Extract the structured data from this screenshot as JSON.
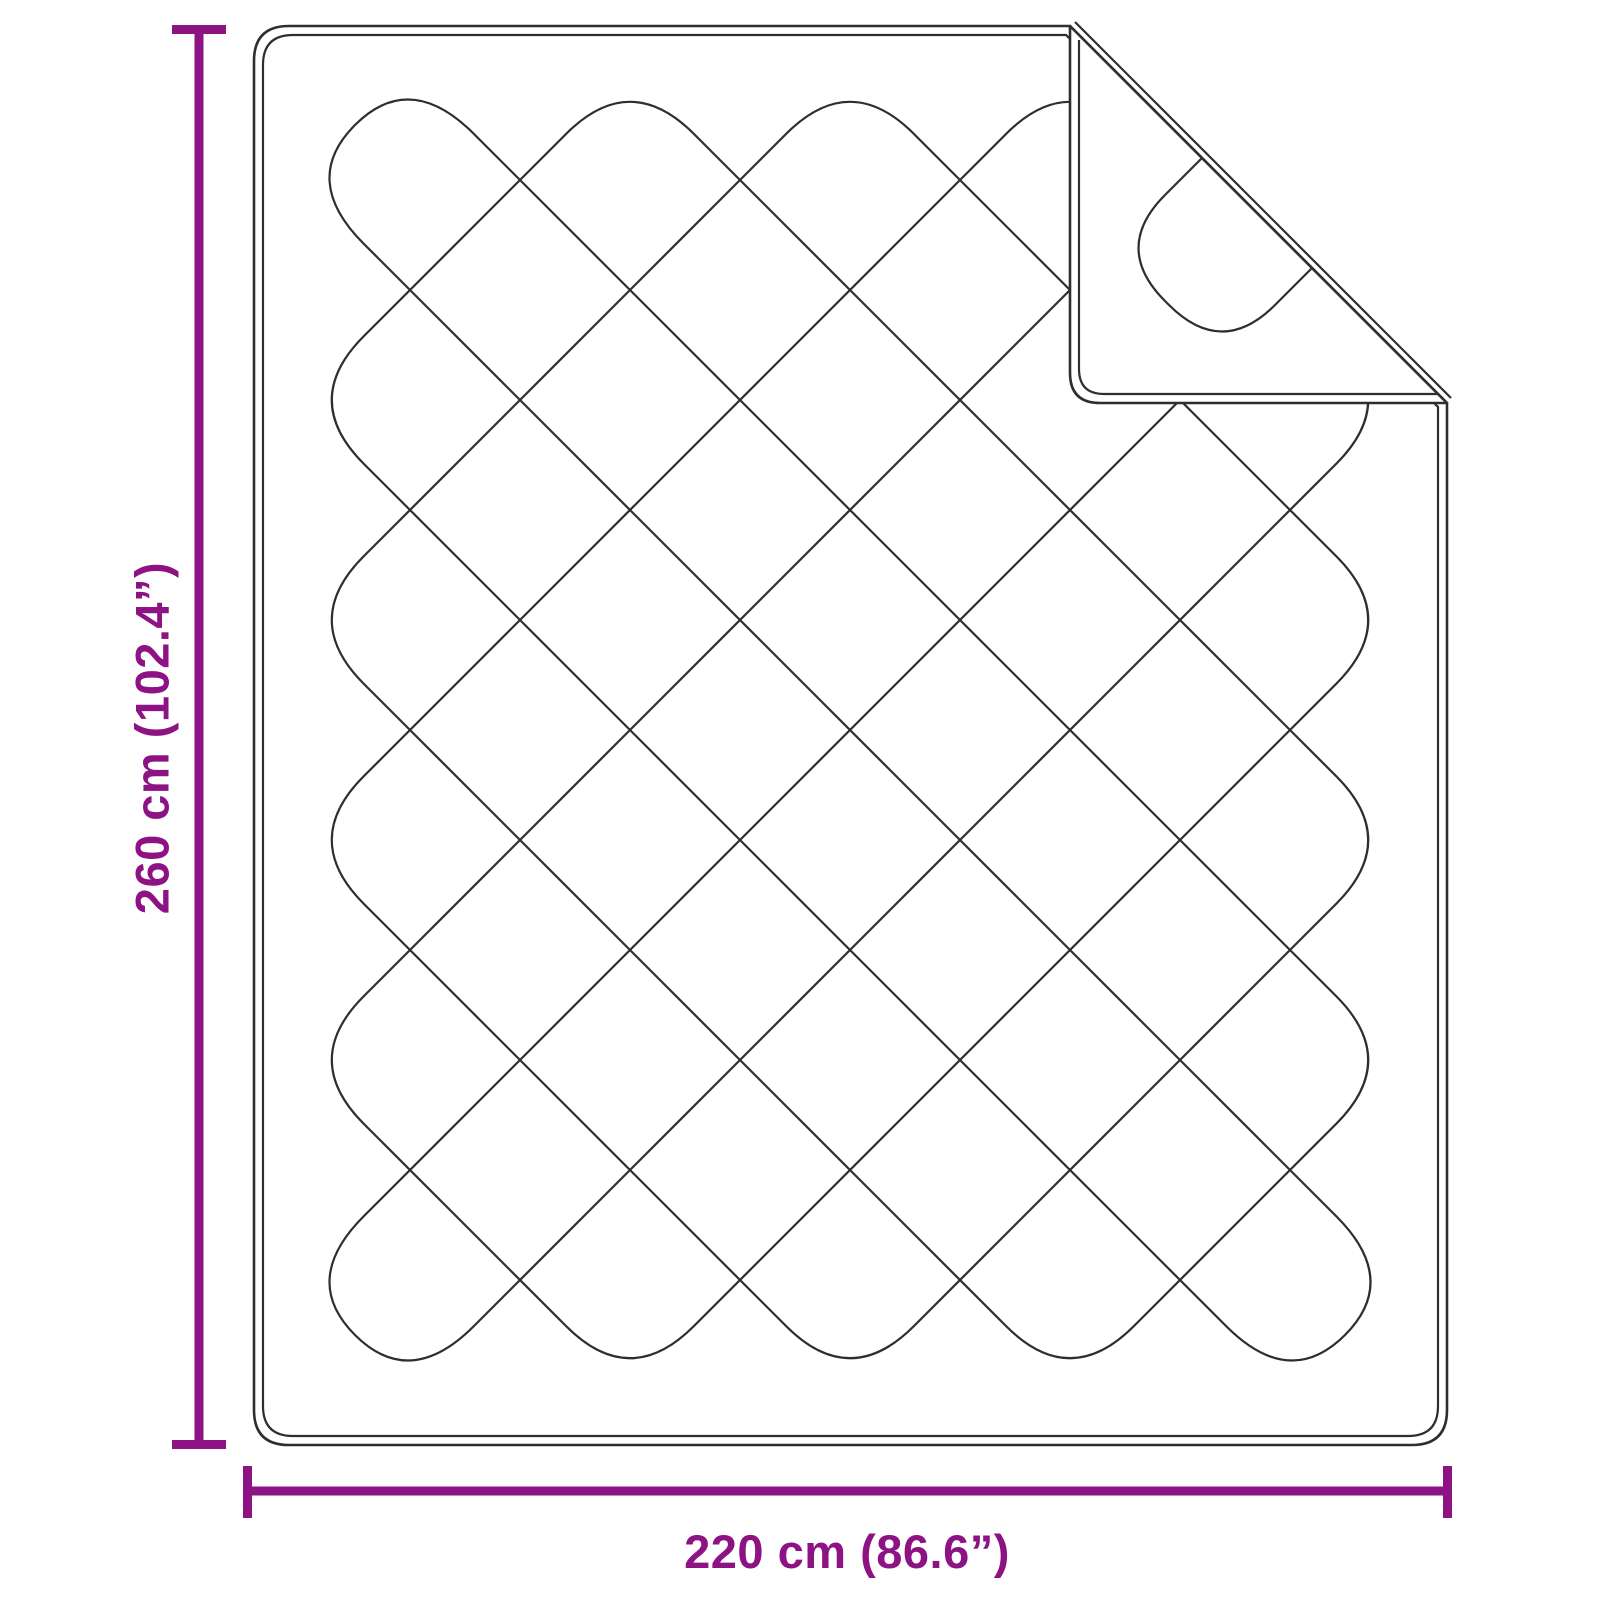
{
  "diagram": {
    "subject": "quilted-blanket-dimension-diagram",
    "height_label": "260 cm (102.4”)",
    "width_label": "220 cm (86.6”)"
  },
  "colors": {
    "accent": "#8D1283",
    "line": "#2e2e2e",
    "background": "#ffffff"
  }
}
